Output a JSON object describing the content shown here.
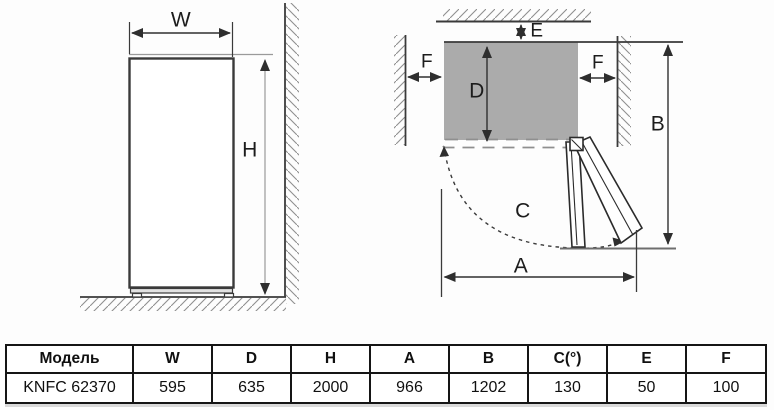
{
  "front_view": {
    "label_width": "W",
    "label_height": "H"
  },
  "top_view": {
    "label_depth": "D",
    "label_rear_gap": "E",
    "label_side_gap_left": "F",
    "label_side_gap_right": "F",
    "label_open_width": "A",
    "label_total_depth": "B",
    "label_door_angle": "C"
  },
  "table": {
    "headers": [
      "Модель",
      "W",
      "D",
      "H",
      "A",
      "B",
      "C(°)",
      "E",
      "F"
    ],
    "rows": [
      [
        "KNFC 62370",
        "595",
        "635",
        "2000",
        "966",
        "1202",
        "130",
        "50",
        "100"
      ]
    ]
  },
  "colors": {
    "line_dark": "#343434",
    "line_light": "#9a9a9a",
    "body_fill_gray": "#ababab",
    "hatch_gray": "#8f8f8f",
    "table_border": "#151515"
  }
}
